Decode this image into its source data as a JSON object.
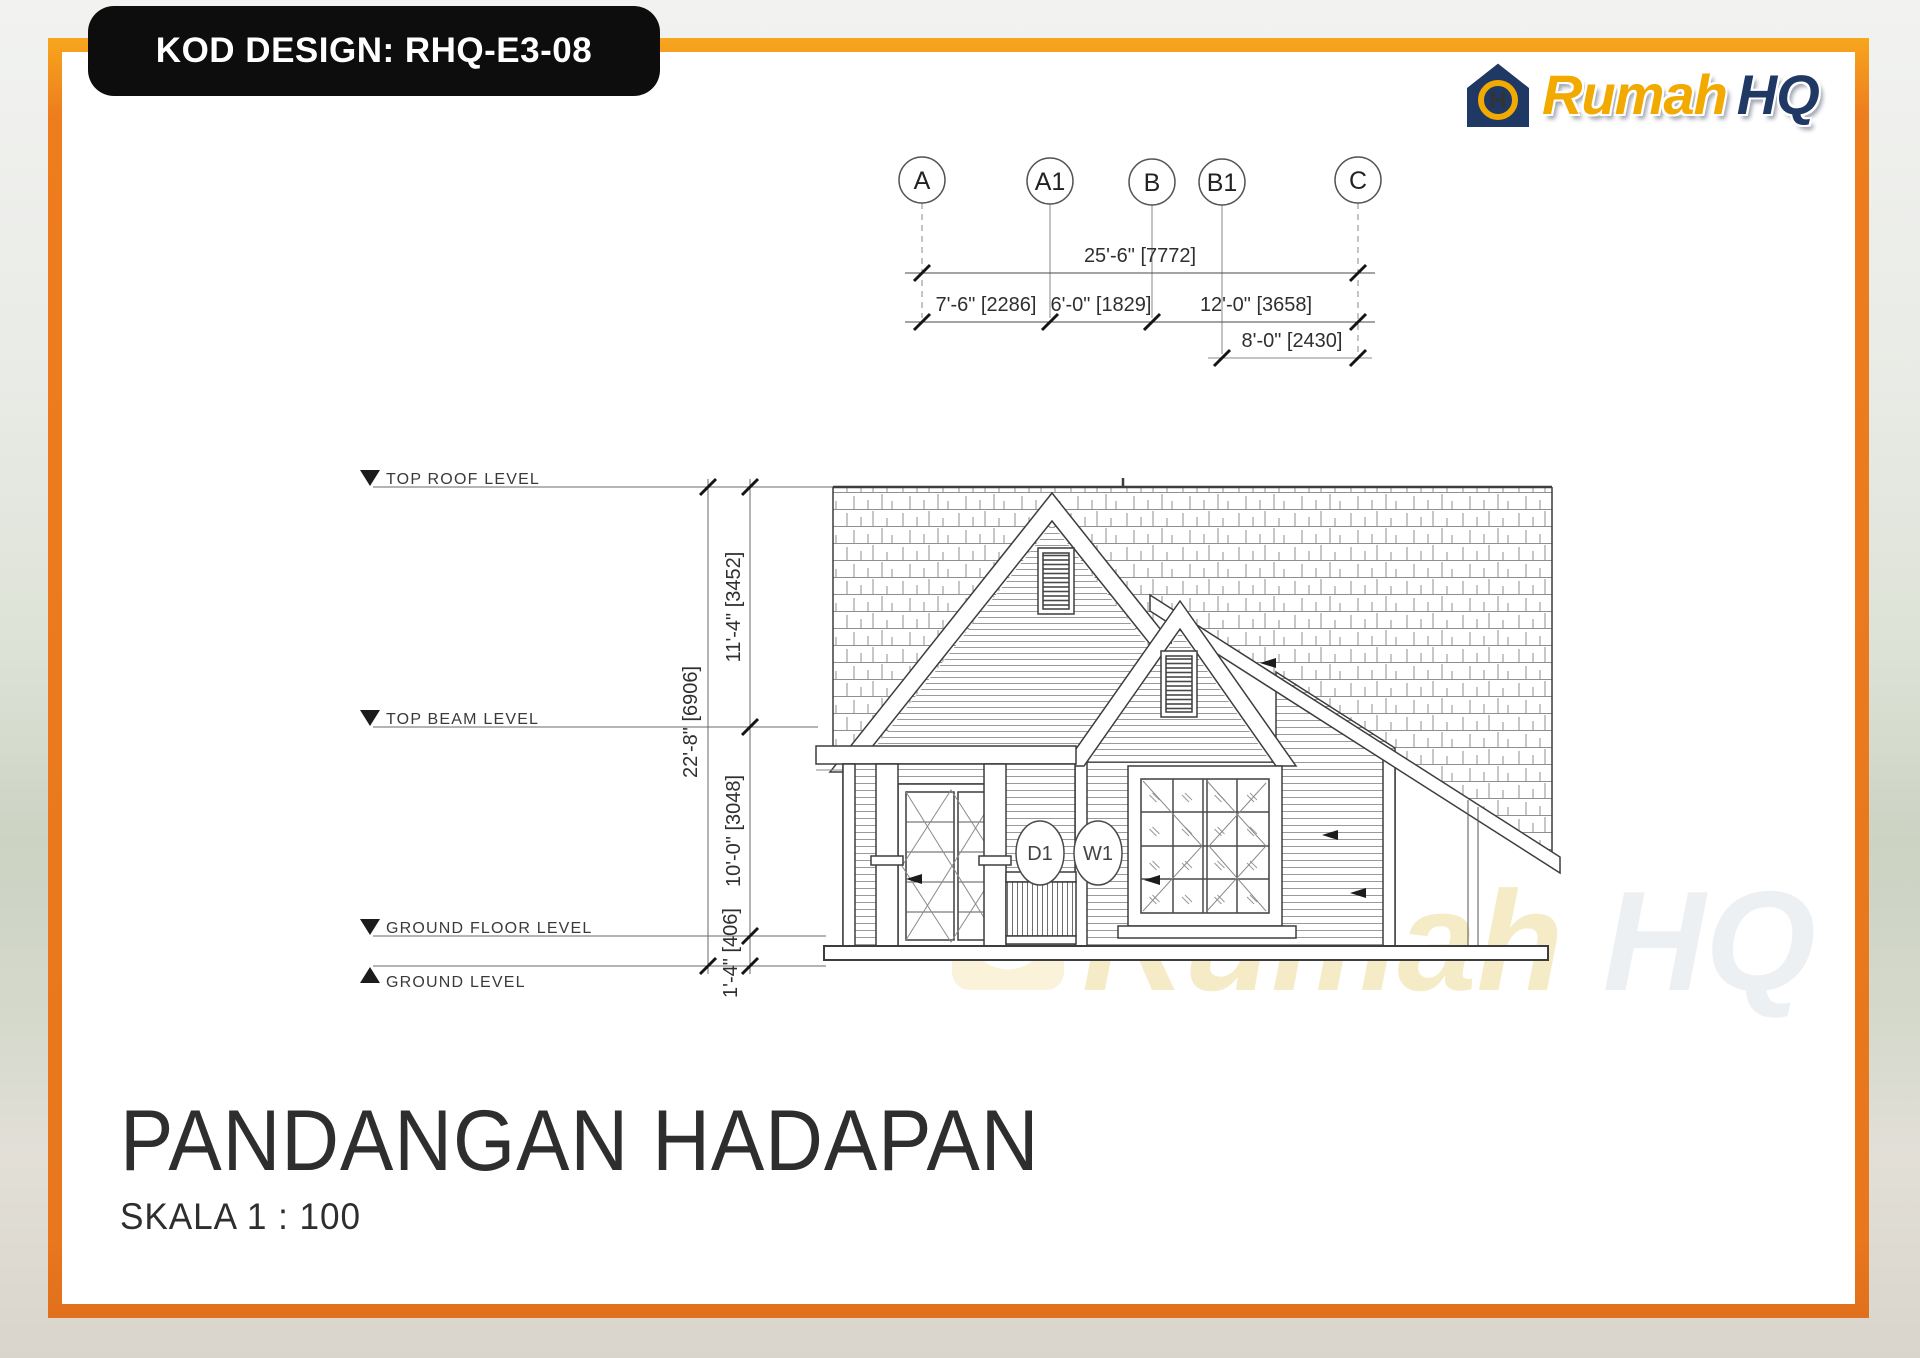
{
  "badge": {
    "label": "KOD DESIGN: RHQ-E3-08"
  },
  "logo": {
    "word1": "Rumah",
    "word2": "HQ",
    "monogram": "H",
    "gold": "#F2A900",
    "navy": "#1F3864"
  },
  "grid": {
    "bubbles": [
      {
        "label": "A"
      },
      {
        "label": "A1"
      },
      {
        "label": "B"
      },
      {
        "label": "B1"
      },
      {
        "label": "C"
      }
    ],
    "dims": {
      "overall": "25'-6\" [7772]",
      "seg1": "7'-6\" [2286]",
      "seg2": "6'-0\" [1829]",
      "seg3": "12'-0\" [3658]",
      "seg4": "8'-0\" [2430]"
    }
  },
  "levels": {
    "top_roof": "TOP ROOF LEVEL",
    "top_beam": "TOP BEAM LEVEL",
    "ground_floor": "GROUND FLOOR LEVEL",
    "ground": "GROUND LEVEL"
  },
  "vdims": {
    "total": "22'-8\" [6906]",
    "roof_to_beam": "11'-4\" [3452]",
    "beam_to_floor": "10'-0\" [3048]",
    "floor_to_ground": "1'-4\" [406]"
  },
  "tags": {
    "door": "D1",
    "window": "W1"
  },
  "title": {
    "text": "PANDANGAN HADAPAN",
    "scale": "SKALA 1 : 100"
  },
  "watermark": {
    "word1": "Rumah",
    "word2": "HQ"
  },
  "colors": {
    "frame_orange": "#EC7E1F",
    "badge_black": "#0D0D0D",
    "logo_gold": "#F2A900",
    "logo_navy": "#1F3864",
    "line": "#3D3D3D"
  }
}
